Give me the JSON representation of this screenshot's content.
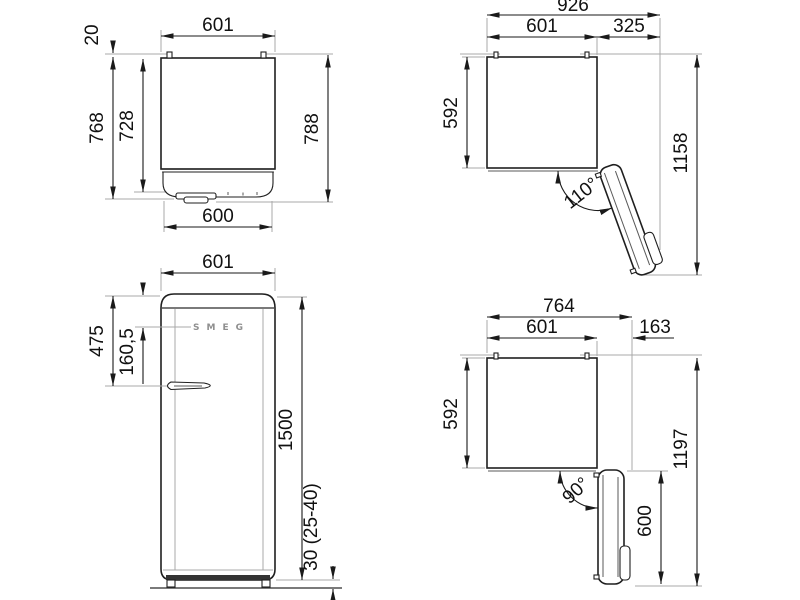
{
  "title": "Refrigerator dimension drawing",
  "colors": {
    "ink": "#1a1a1a",
    "extension_gray": "#a8a8a8",
    "logo_gray": "#8f8f8f",
    "background": "#ffffff"
  },
  "views": {
    "plan_closed": {
      "label": "top view - door closed",
      "dims": {
        "width_top": "601",
        "hinge_depth": "20",
        "depth_body": "768",
        "depth_door": "728",
        "depth_total": "788",
        "width_door": "600"
      }
    },
    "plan_open_110": {
      "label": "top view - door open 110 degrees",
      "dims": {
        "width_total": "926",
        "width_body": "601",
        "door_projection": "325",
        "depth_body": "592",
        "depth_total": "1158",
        "angle": "110°"
      }
    },
    "front": {
      "label": "front view",
      "logo": "SMEG",
      "dims": {
        "width": "601",
        "handle_offset": "475",
        "logo_offset": "160,5",
        "height": "1500",
        "feet_height": "30 (25-40)"
      }
    },
    "plan_open_90": {
      "label": "top view - door open 90 degrees",
      "dims": {
        "width_total": "764",
        "width_body": "601",
        "side_projection": "163",
        "depth_body": "592",
        "depth_total": "1197",
        "door_width": "600",
        "angle": "90°"
      }
    }
  }
}
